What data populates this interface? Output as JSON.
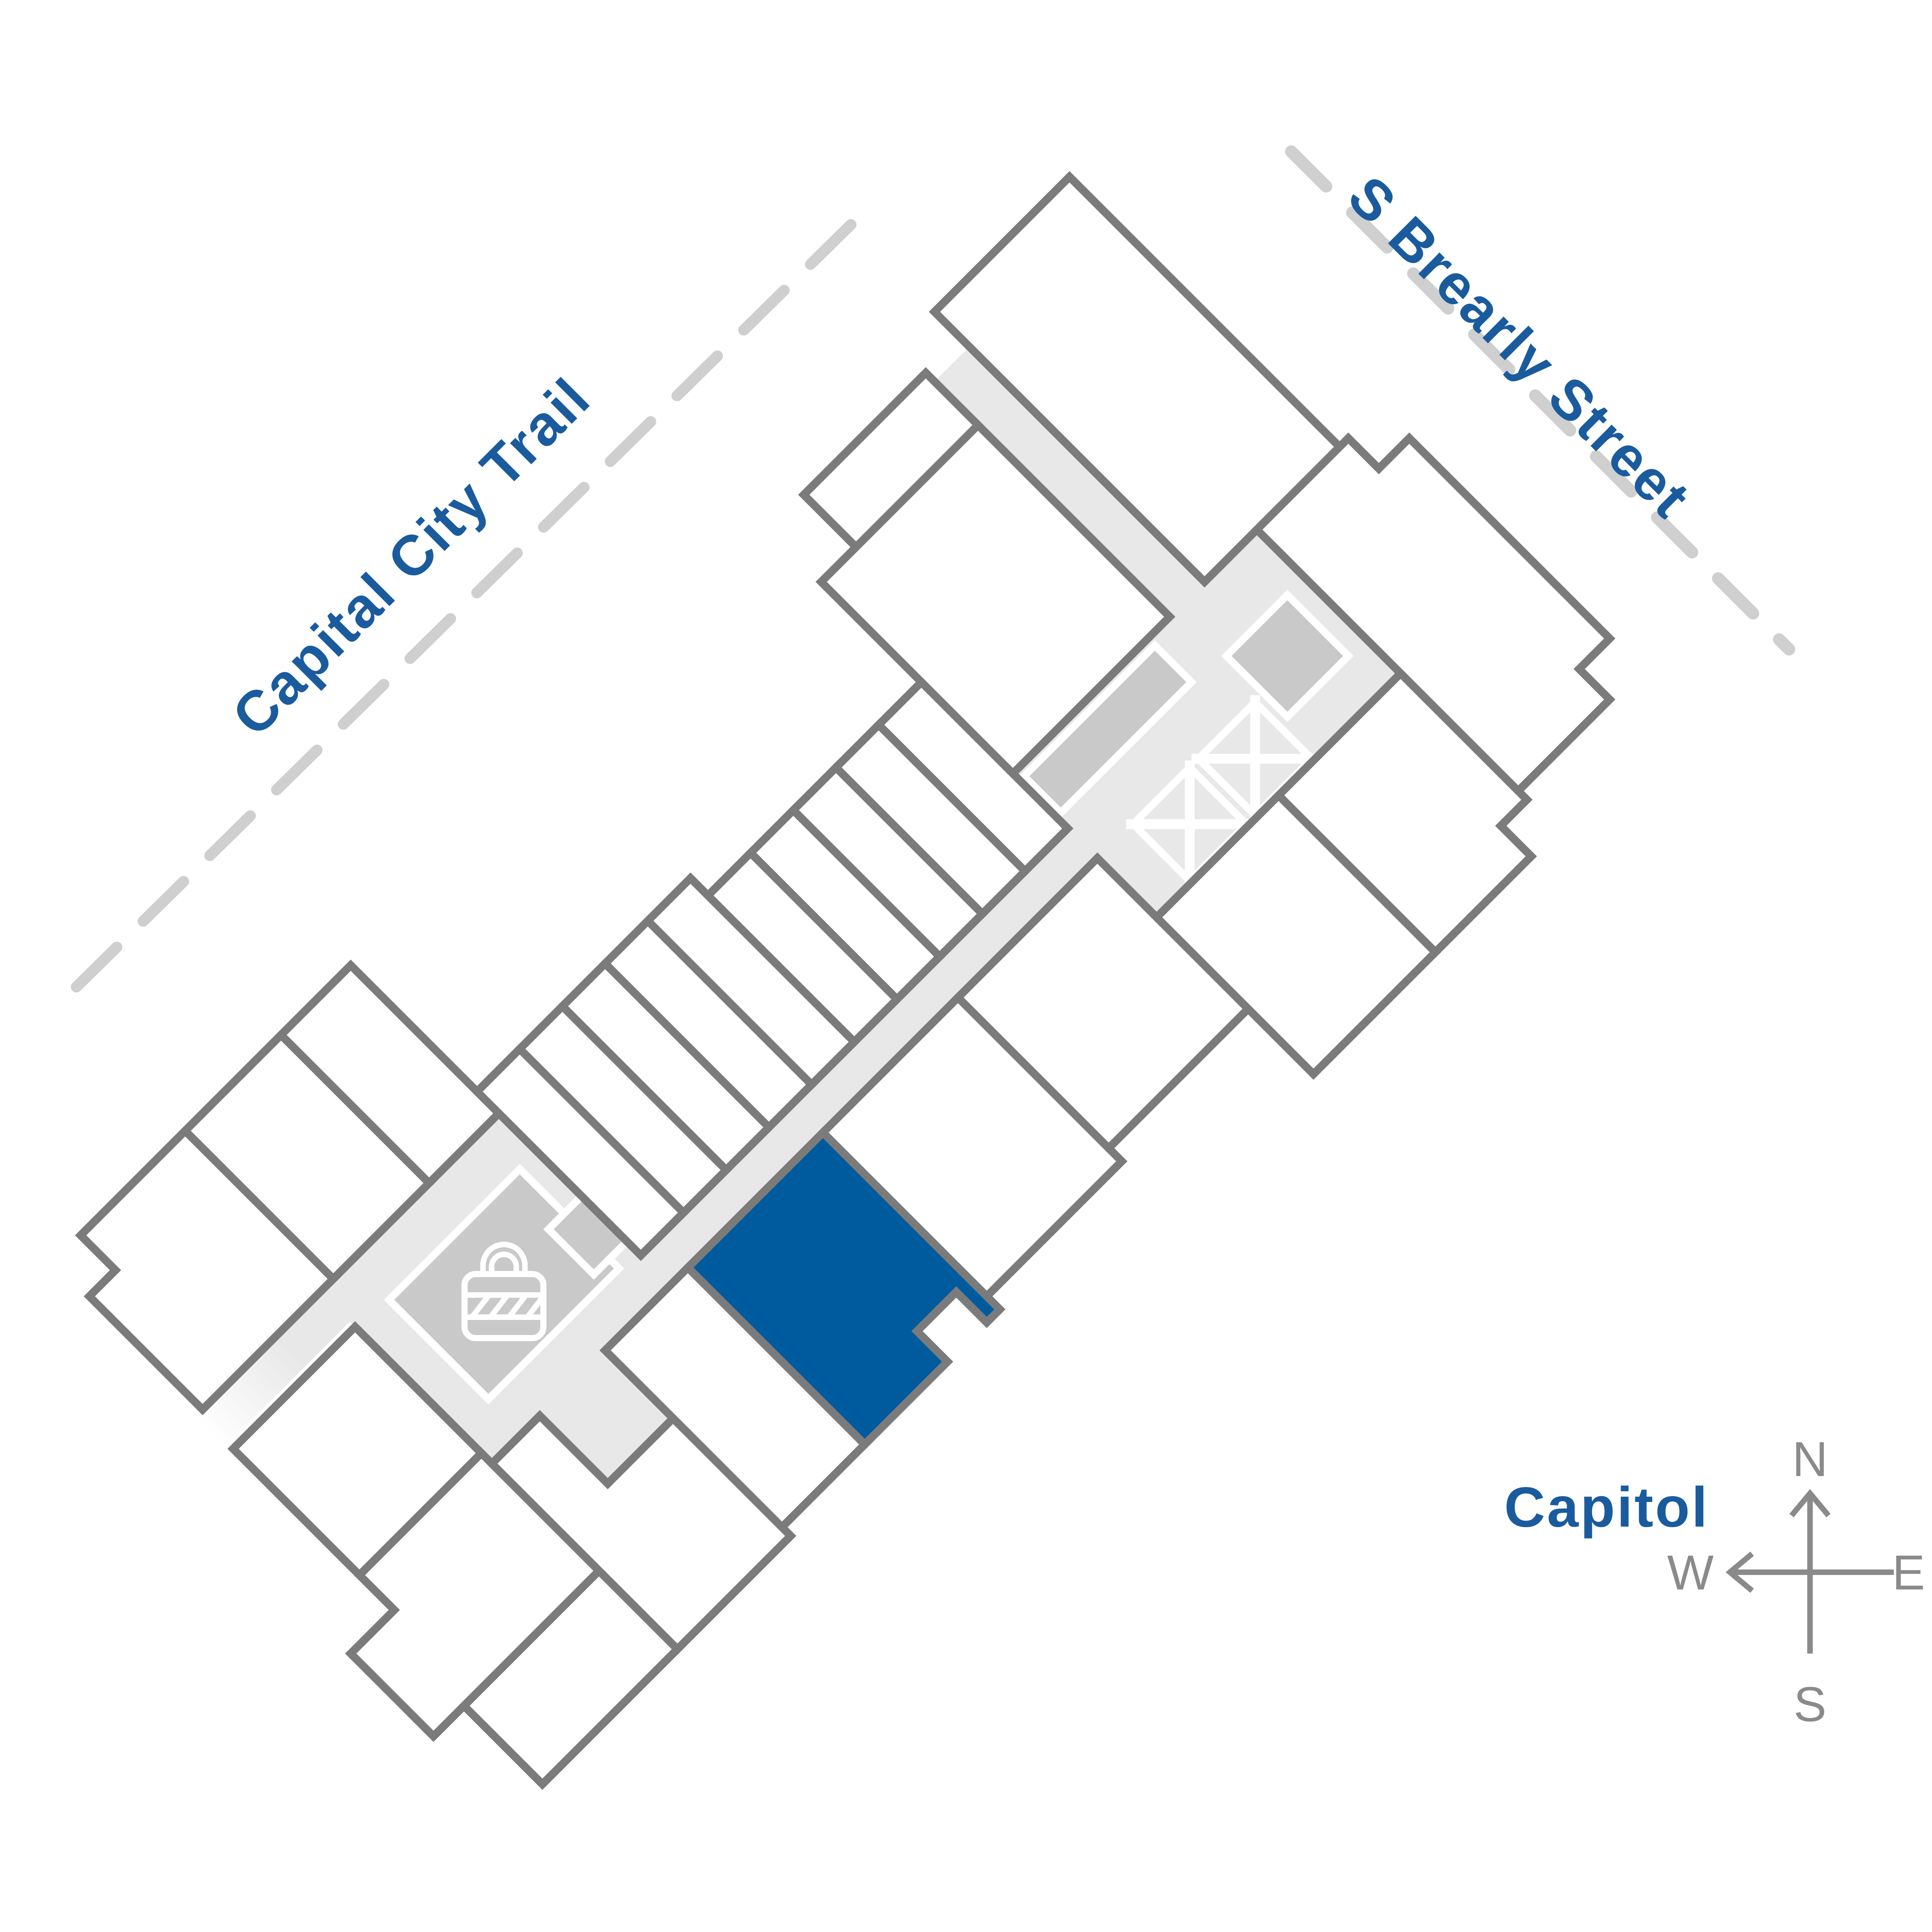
{
  "page": {
    "background": "#FFFFFF",
    "type": "community-site-plan"
  },
  "labels": {
    "trail": "Capital City Trail",
    "street": "S Brearly Street",
    "capitol": "Capitol"
  },
  "compass": {
    "north": "N",
    "east": "E",
    "south": "S",
    "west": "W"
  },
  "colors": {
    "accent": "#005B9E",
    "label": "#1A5B9E",
    "outline": "#7B7B7B",
    "corridor": "#E8E8E8",
    "block": "#C9C9C9",
    "dash": "#CFCFCF",
    "compass": "#8A8A8A",
    "unit_fill": "#FFFFFF"
  },
  "site_plan": {
    "building_rotation_deg": -45,
    "highlighted_unit": {
      "state": "selected",
      "fill": "#005B9E"
    },
    "amenities": [
      {
        "icon": "lock-icon",
        "location": "lower-lobby"
      },
      {
        "icon": "elevator-x-icon",
        "count": 2,
        "location": "upper-lobby"
      }
    ]
  }
}
